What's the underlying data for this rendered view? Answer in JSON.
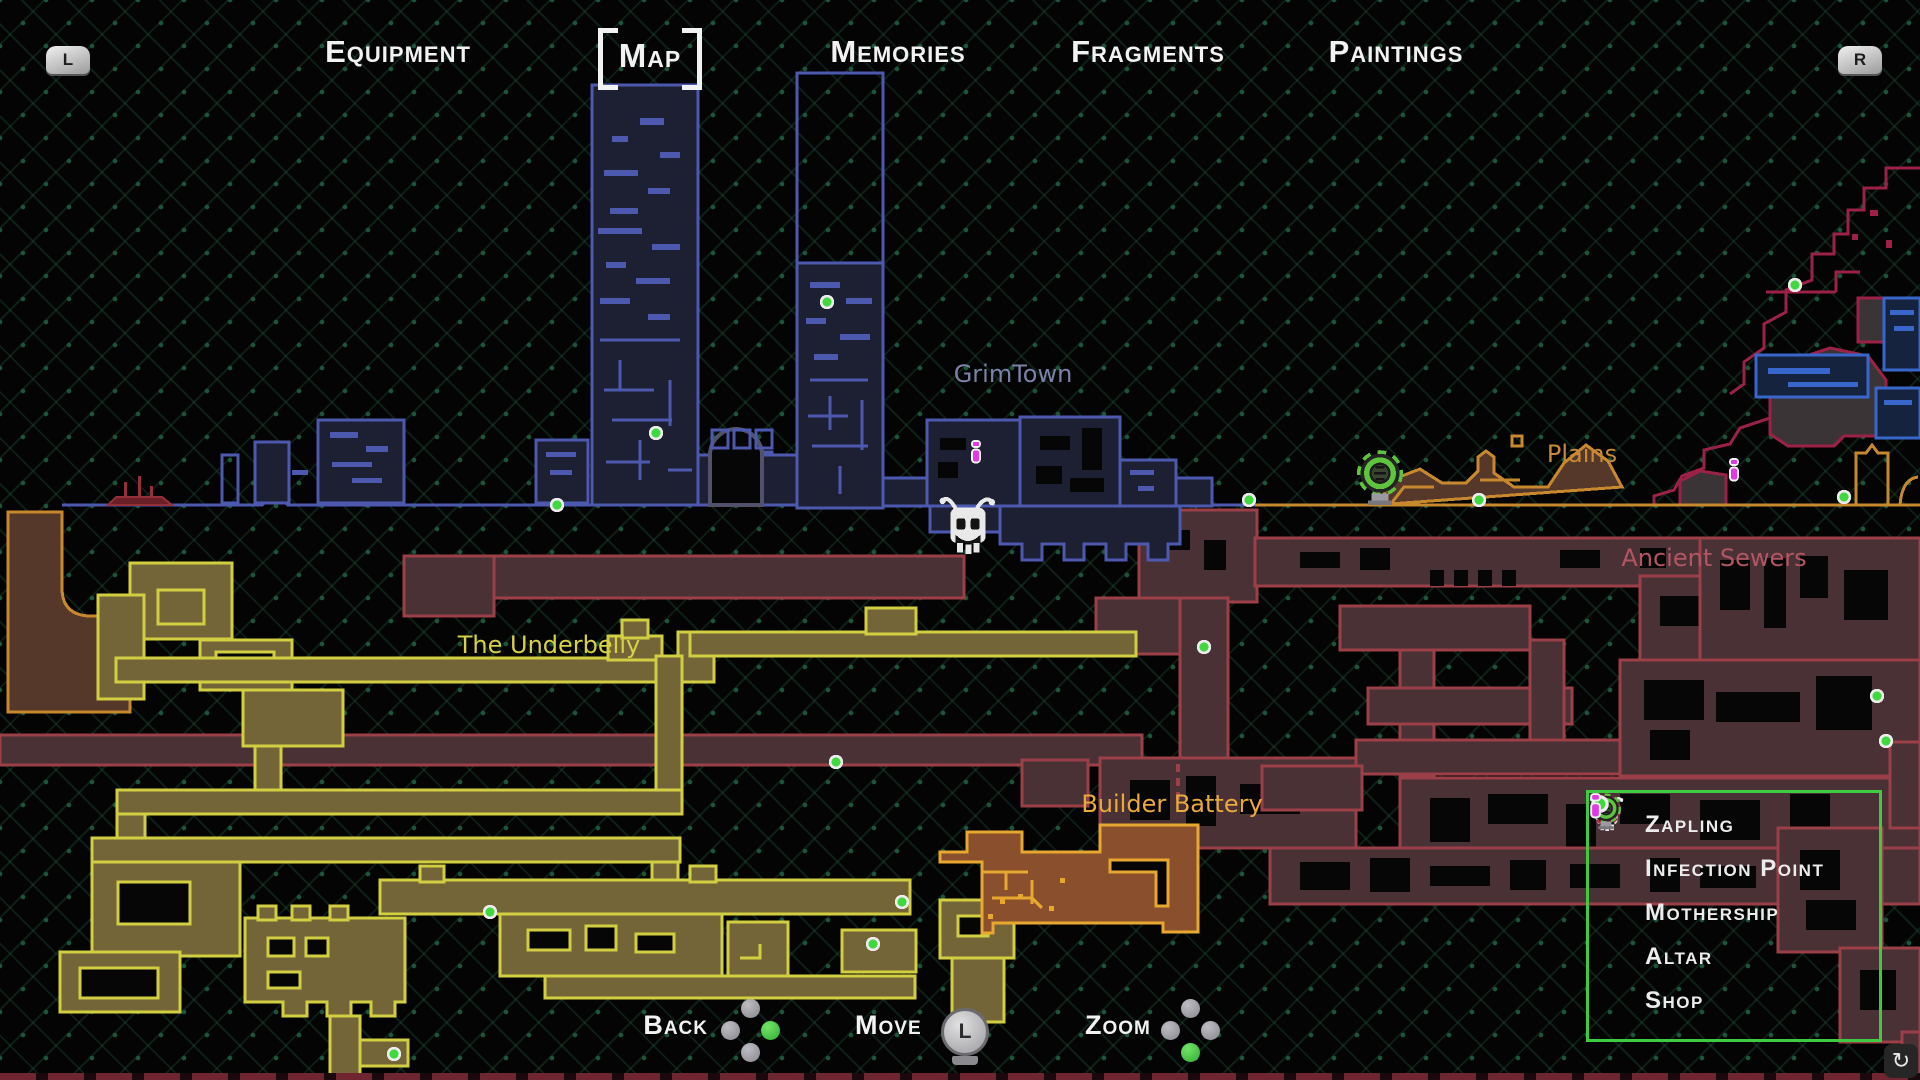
{
  "nav": {
    "left_shoulder_label": "L",
    "right_shoulder_label": "R",
    "tabs": [
      {
        "label": "Equipment",
        "active": false
      },
      {
        "label": "Map",
        "active": true
      },
      {
        "label": "Memories",
        "active": false
      },
      {
        "label": "Fragments",
        "active": false
      },
      {
        "label": "Paintings",
        "active": false
      }
    ]
  },
  "map": {
    "regions": [
      {
        "label": "GrimTown",
        "color": "#7b82a8",
        "outline": "#4d59ae"
      },
      {
        "label": "Plains",
        "color": "#c98a35",
        "outline": "#c8882e"
      },
      {
        "label": "Ancient Sewers",
        "color": "#b25663",
        "outline": "#9c4048"
      },
      {
        "label": "The Underbelly",
        "color": "#d6d145",
        "outline": "#d2ce41"
      },
      {
        "label": "Builder Battery",
        "color": "#eaa93c",
        "outline": "#e8a830"
      }
    ],
    "markers": [
      {
        "type": "zapling",
        "x": 968,
        "y": 524
      },
      {
        "type": "mothership",
        "x": 1380,
        "y": 478
      },
      {
        "type": "shop",
        "x": 976,
        "y": 452
      },
      {
        "type": "shop",
        "x": 1734,
        "y": 470
      },
      {
        "type": "altar",
        "x": 557,
        "y": 505
      },
      {
        "type": "altar",
        "x": 656,
        "y": 433
      },
      {
        "type": "altar",
        "x": 827,
        "y": 302
      },
      {
        "type": "altar",
        "x": 1249,
        "y": 500
      },
      {
        "type": "altar",
        "x": 1479,
        "y": 500
      },
      {
        "type": "altar",
        "x": 1844,
        "y": 497
      },
      {
        "type": "altar",
        "x": 1795,
        "y": 285
      },
      {
        "type": "altar",
        "x": 1204,
        "y": 647
      },
      {
        "type": "altar",
        "x": 836,
        "y": 762
      },
      {
        "type": "altar",
        "x": 1877,
        "y": 696
      },
      {
        "type": "altar",
        "x": 1886,
        "y": 741
      },
      {
        "type": "altar",
        "x": 490,
        "y": 912
      },
      {
        "type": "altar",
        "x": 902,
        "y": 902
      },
      {
        "type": "altar",
        "x": 873,
        "y": 944
      },
      {
        "type": "altar",
        "x": 394,
        "y": 1054
      }
    ]
  },
  "legend": {
    "border_color": "#3ecb41",
    "items": [
      {
        "icon": "zapling-skull-icon",
        "label": "Zapling"
      },
      {
        "icon": "infection-point-icon",
        "label": "Infection Point"
      },
      {
        "icon": "mothership-icon",
        "label": "Mothership"
      },
      {
        "icon": "altar-icon",
        "label": "Altar"
      },
      {
        "icon": "shop-icon",
        "label": "Shop"
      }
    ]
  },
  "controls": [
    {
      "label": "Back",
      "input": "face-buttons",
      "active_button": "right"
    },
    {
      "label": "Move",
      "input": "left-stick",
      "stick_label": "L"
    },
    {
      "label": "Zoom",
      "input": "face-buttons",
      "active_button": "down"
    }
  ],
  "colors": {
    "altar_green": "#3fd93f",
    "mothership_green": "#5ec43e",
    "shop_magenta": "#e23ae2",
    "infection_red": "#a82c4c",
    "legend_border": "#3ecb41"
  }
}
